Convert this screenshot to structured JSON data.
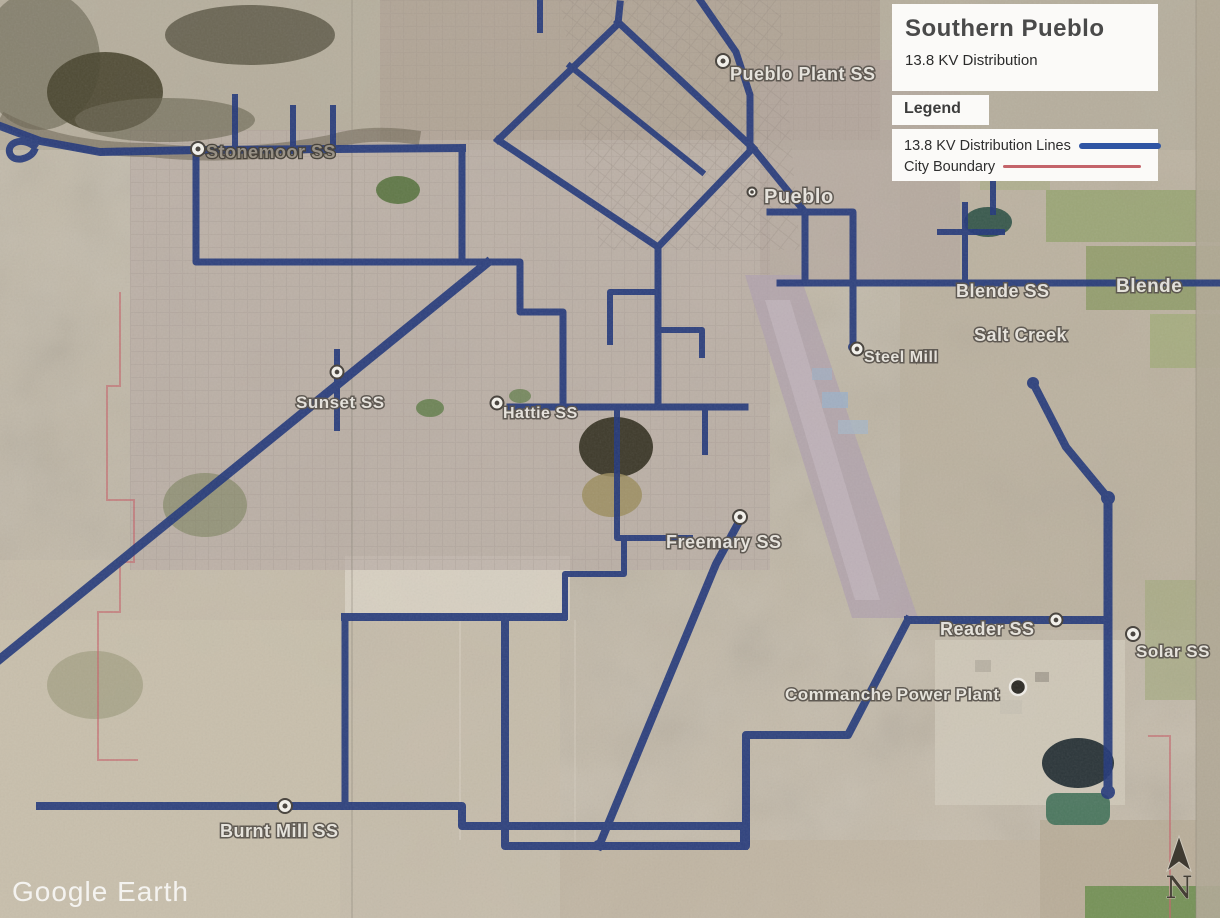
{
  "title_block": {
    "title": "Southern Pueblo",
    "subtitle": "13.8 KV Distribution"
  },
  "legend": {
    "heading": "Legend",
    "items": [
      {
        "name": "distribution-lines",
        "label": "13.8 KV Distribution Lines",
        "color": "#2f55a4"
      },
      {
        "name": "city-boundary",
        "label": "City Boundary",
        "color": "#c4646a"
      }
    ]
  },
  "map": {
    "watermark": "Google Earth",
    "compass_label": "N",
    "colors": {
      "distribution_line": "#24397b",
      "city_boundary": "#c4646a"
    },
    "labels": [
      {
        "name": "pueblo-plant-ss",
        "text": "Pueblo Plant SS",
        "x": 730,
        "y": 80,
        "size": 18,
        "style": "place"
      },
      {
        "name": "stonemoor-ss",
        "text": "Stonemoor SS",
        "x": 206,
        "y": 158,
        "size": 18,
        "style": "dark"
      },
      {
        "name": "pueblo",
        "text": "Pueblo",
        "x": 764,
        "y": 203,
        "size": 20,
        "style": "place"
      },
      {
        "name": "blende-ss",
        "text": "Blende SS",
        "x": 956,
        "y": 297,
        "size": 18,
        "style": "place"
      },
      {
        "name": "blende",
        "text": "Blende",
        "x": 1116,
        "y": 292,
        "size": 19,
        "style": "place"
      },
      {
        "name": "salt-creek",
        "text": "Salt Creek",
        "x": 974,
        "y": 341,
        "size": 18,
        "style": "place"
      },
      {
        "name": "steel-mill",
        "text": "Steel Mill",
        "x": 864,
        "y": 362,
        "size": 16,
        "style": "place"
      },
      {
        "name": "sunset-ss",
        "text": "Sunset SS",
        "x": 296,
        "y": 408,
        "size": 17,
        "style": "place"
      },
      {
        "name": "hattie-ss",
        "text": "Hattie SS",
        "x": 503,
        "y": 418,
        "size": 16,
        "style": "place"
      },
      {
        "name": "freemary-ss",
        "text": "Freemary SS",
        "x": 666,
        "y": 548,
        "size": 18,
        "style": "place"
      },
      {
        "name": "reader-ss",
        "text": "Reader SS",
        "x": 940,
        "y": 635,
        "size": 18,
        "style": "place"
      },
      {
        "name": "solar-ss",
        "text": "Solar SS",
        "x": 1136,
        "y": 657,
        "size": 17,
        "style": "place"
      },
      {
        "name": "commanche-power-plant",
        "text": "Commanche Power Plant",
        "x": 785,
        "y": 700,
        "size": 17,
        "style": "place"
      },
      {
        "name": "burnt-mill-ss",
        "text": "Burnt Mill SS",
        "x": 220,
        "y": 837,
        "size": 18,
        "style": "place"
      }
    ],
    "markers": [
      {
        "name": "pueblo-plant-ss-marker",
        "x": 723,
        "y": 61,
        "kind": "ring",
        "r": 7
      },
      {
        "name": "stonemoor-ss-marker",
        "x": 198,
        "y": 149,
        "kind": "ring",
        "r": 7
      },
      {
        "name": "pueblo-marker",
        "x": 752,
        "y": 192,
        "kind": "ring",
        "r": 4.5
      },
      {
        "name": "steel-mill-marker",
        "x": 857,
        "y": 349,
        "kind": "ring",
        "r": 6.5
      },
      {
        "name": "sunset-ss-marker",
        "x": 337,
        "y": 372,
        "kind": "ring",
        "r": 6.5
      },
      {
        "name": "hattie-ss-marker",
        "x": 497,
        "y": 403,
        "kind": "ring",
        "r": 6.5
      },
      {
        "name": "freemary-ss-marker",
        "x": 740,
        "y": 517,
        "kind": "ring",
        "r": 7
      },
      {
        "name": "reader-ss-marker",
        "x": 1056,
        "y": 620,
        "kind": "ring",
        "r": 6.5
      },
      {
        "name": "solar-ss-marker",
        "x": 1133,
        "y": 634,
        "kind": "ring",
        "r": 7
      },
      {
        "name": "burnt-mill-ss-marker",
        "x": 285,
        "y": 806,
        "kind": "ring",
        "r": 7
      },
      {
        "name": "commanche-power-plant-marker",
        "x": 1018,
        "y": 687,
        "kind": "dot",
        "r": 8
      }
    ]
  }
}
